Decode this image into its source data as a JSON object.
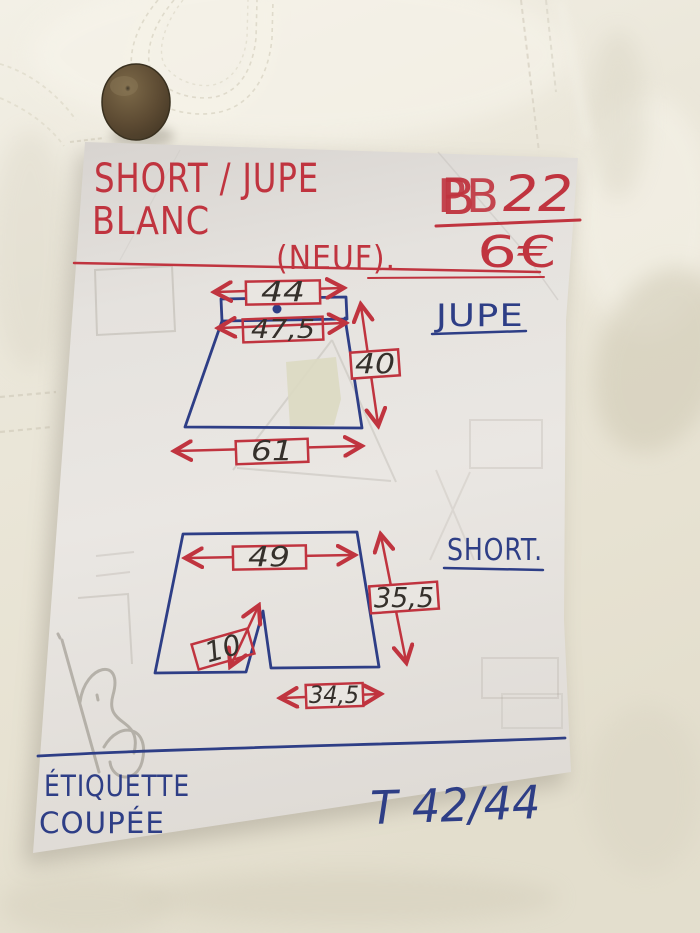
{
  "photo": {
    "description": "handwritten measurement note pinned on white garment",
    "garment_button_icon": "brass-button-icon",
    "fabric": "white-garment-fabric"
  },
  "note": {
    "title_line1": "SHORT / JUPE",
    "title_line2": "BLANC",
    "lot": {
      "overwritten": "PB",
      "overlay": "B",
      "number": "22"
    },
    "condition": "(NEUF).",
    "price": "6€",
    "jupe": {
      "label": "JUPE",
      "top_width": "44",
      "waist_width": "47,5",
      "length": "40",
      "hem_width": "61"
    },
    "short": {
      "label": "SHORT.",
      "waist_width": "49",
      "length": "35,5",
      "inseam": "10",
      "leg_hem_width": "34,5"
    },
    "footer": {
      "line1": "ÉTIQUETTE",
      "line2": "COUPÉE",
      "size": "T 42/44"
    }
  },
  "colors": {
    "red_ink": "#c0343f",
    "blue_ink": "#2e3e86",
    "black_ink": "#35302b",
    "paper": "#e7e4df",
    "fabric": "#ebe7da",
    "button_brown": "#5d4b33",
    "pencil_ghost": "#a39d92"
  }
}
